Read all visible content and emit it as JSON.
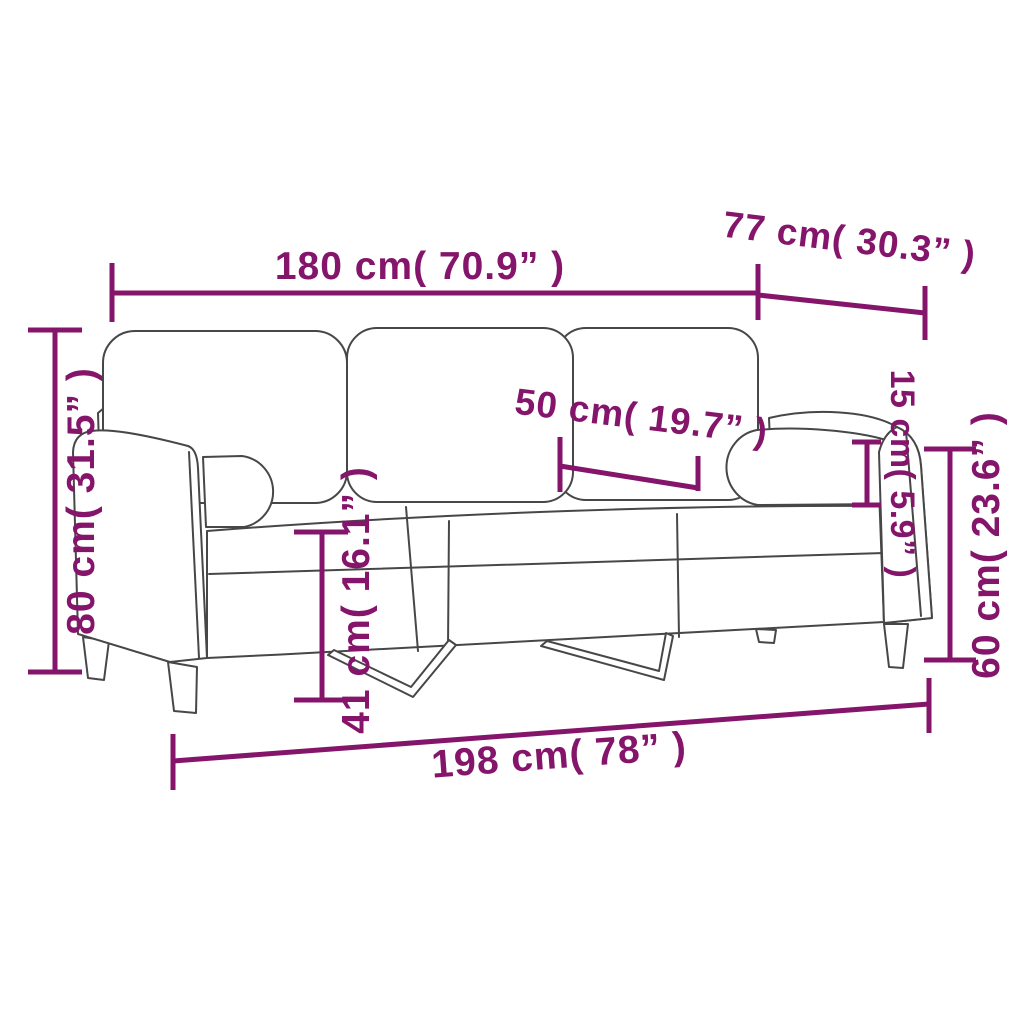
{
  "page": {
    "background": "#ffffff",
    "description": "Dimension diagram of a 3-seater sofa with back cushions and bolster throw pillows"
  },
  "colors": {
    "dimension_accent": "#84156b",
    "drawing_line": "#474747"
  },
  "diagram": {
    "object": "3-seater sofa line drawing",
    "dimensions": {
      "inner_width": {
        "label": "180 cm( 70.9” )",
        "value_cm": 180,
        "value_in": 70.9
      },
      "depth": {
        "label": "77 cm( 30.3” )",
        "value_cm": 77,
        "value_in": 30.3
      },
      "back_height": {
        "label": "80 cm( 31.5” )",
        "value_cm": 80,
        "value_in": 31.5
      },
      "seat_depth": {
        "label": "50 cm( 19.7” )",
        "value_cm": 50,
        "value_in": 19.7
      },
      "pillow_height": {
        "label": "15 cm( 5.9” )",
        "value_cm": 15,
        "value_in": 5.9
      },
      "arm_height": {
        "label": "60 cm( 23.6” )",
        "value_cm": 60,
        "value_in": 23.6
      },
      "seat_height": {
        "label": "41 cm( 16.1” )",
        "value_cm": 41,
        "value_in": 16.1
      },
      "total_width": {
        "label": "198 cm( 78” )",
        "value_cm": 198,
        "value_in": 78
      }
    }
  }
}
